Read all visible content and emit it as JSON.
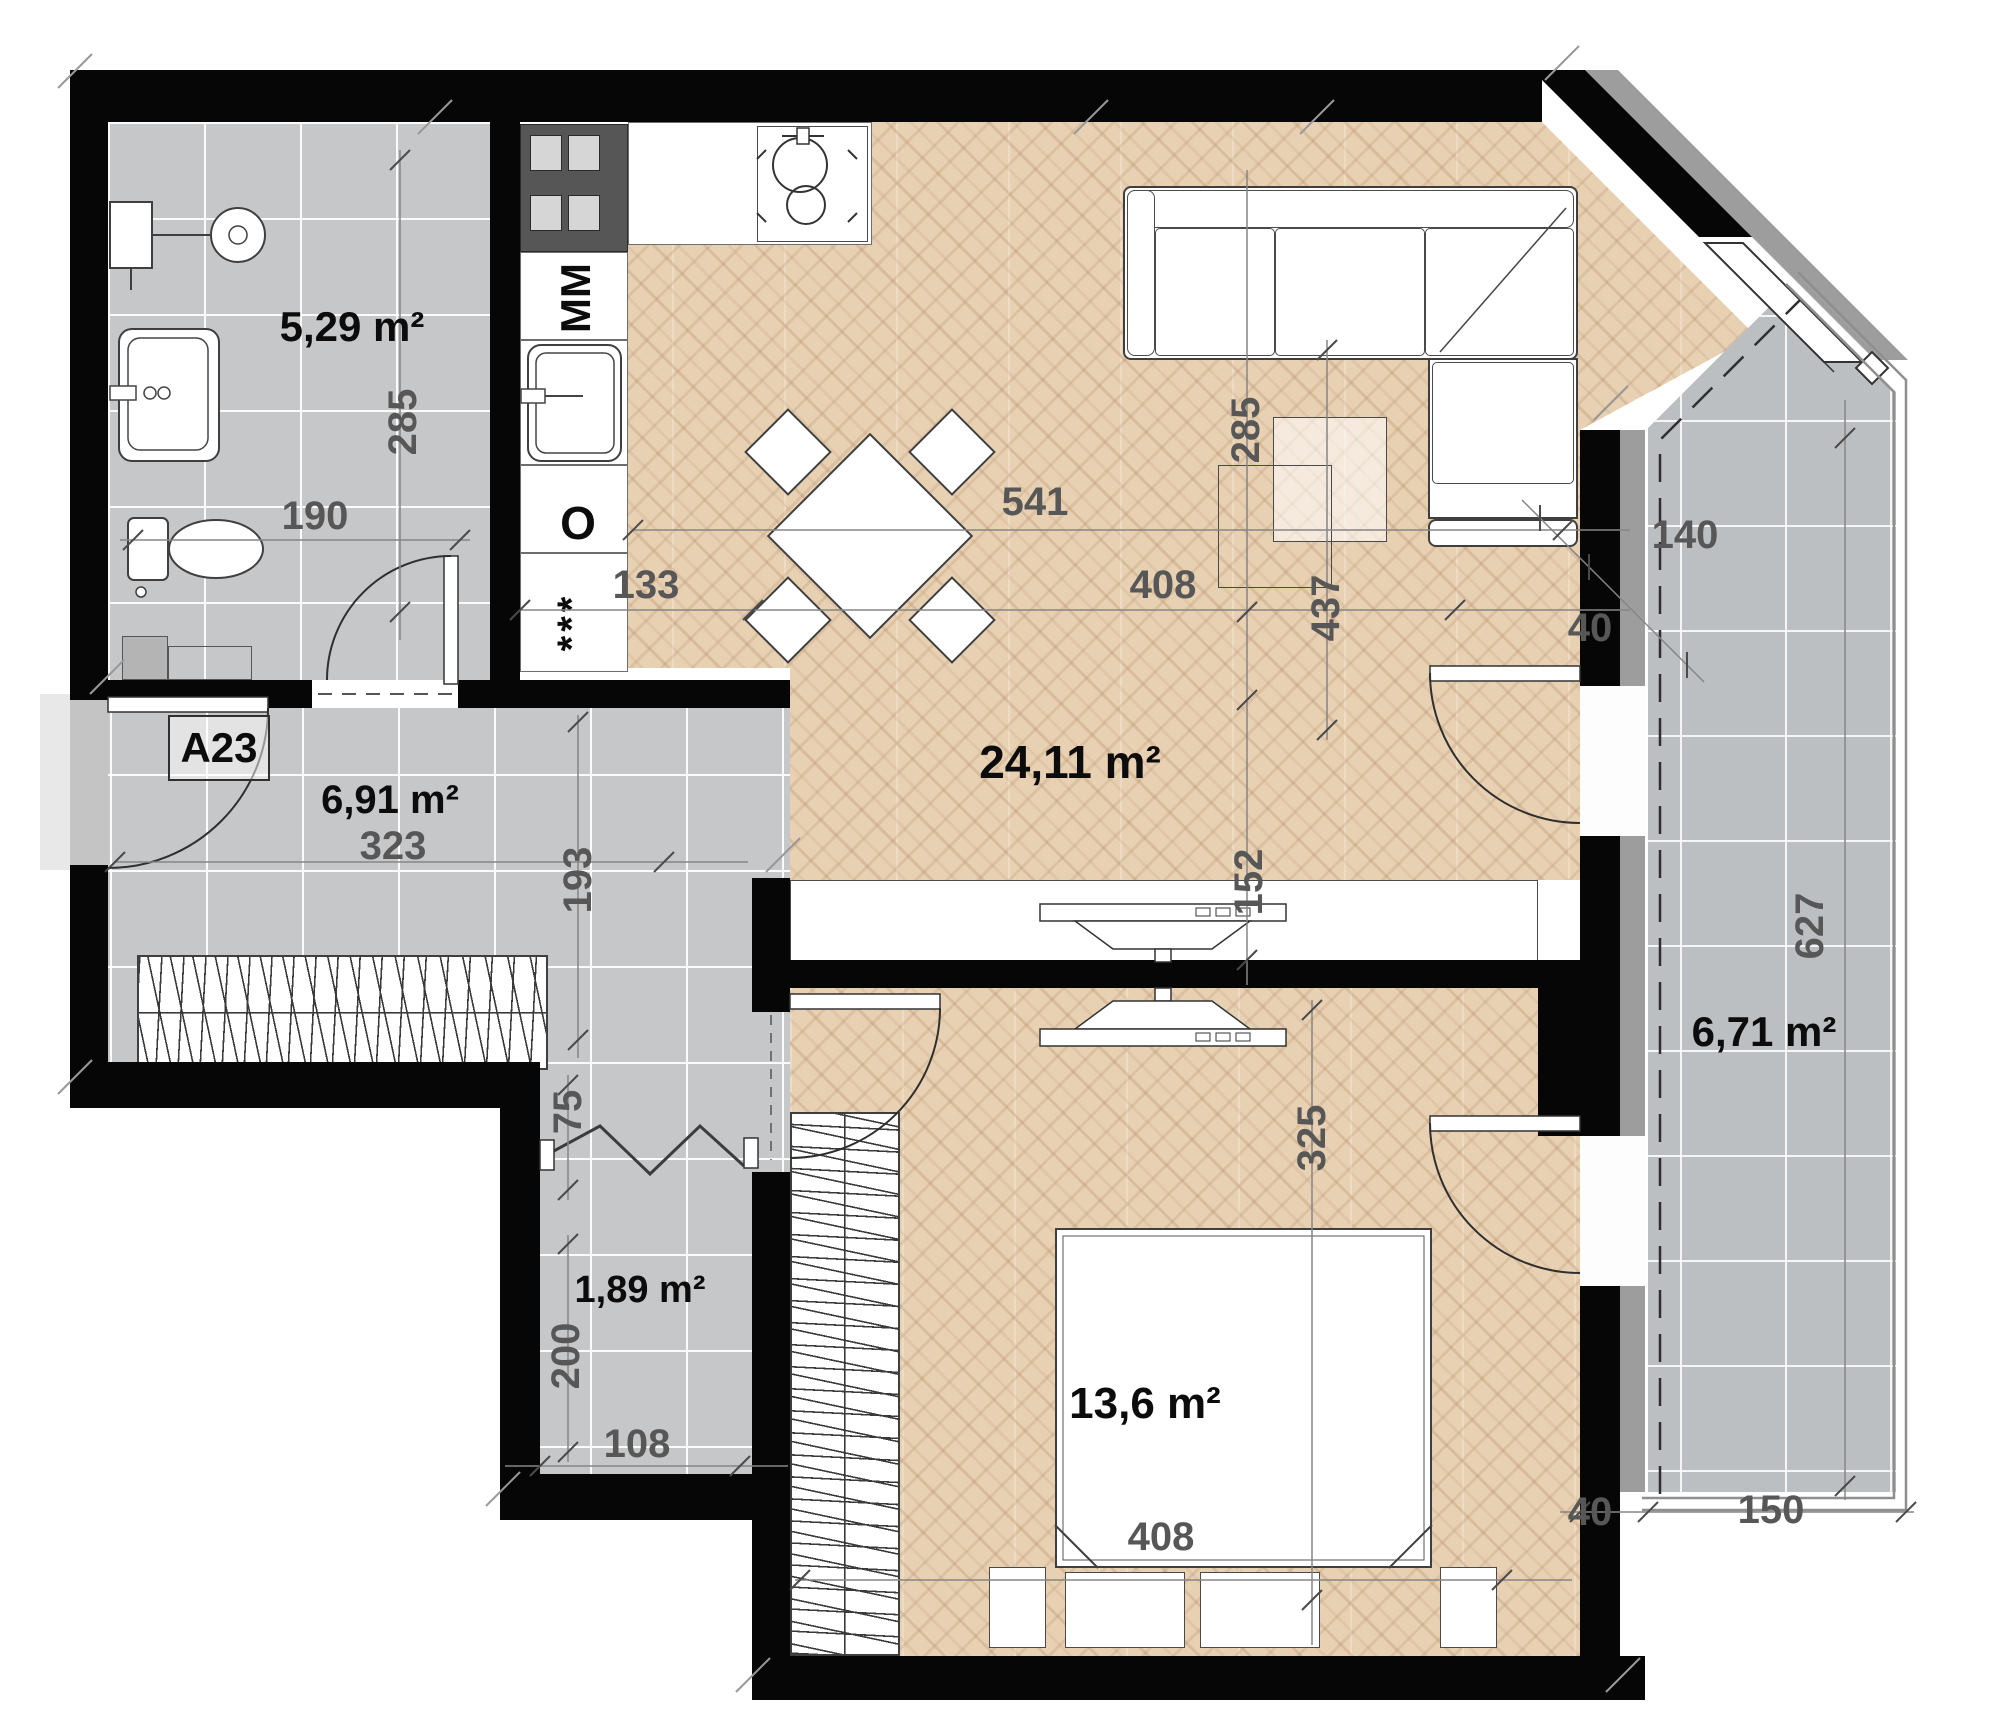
{
  "unit": {
    "id": "A23"
  },
  "rooms": [
    {
      "key": "bathroom",
      "area": "5,29 m²"
    },
    {
      "key": "hall",
      "area": "6,91 m²"
    },
    {
      "key": "storage",
      "area": "1,89 m²"
    },
    {
      "key": "living_kitchen",
      "area": "24,11 m²"
    },
    {
      "key": "bedroom",
      "area": "13,6 m²"
    },
    {
      "key": "balcony",
      "area": "6,71 m²"
    }
  ],
  "kitchen_labels": {
    "dishwasher": "MM",
    "oven": "O",
    "fridge": "***"
  },
  "dimensions": [
    {
      "text": "285"
    },
    {
      "text": "190"
    },
    {
      "text": "133"
    },
    {
      "text": "541"
    },
    {
      "text": "408"
    },
    {
      "text": "285"
    },
    {
      "text": "437"
    },
    {
      "text": "140"
    },
    {
      "text": "40"
    },
    {
      "text": "152"
    },
    {
      "text": "323"
    },
    {
      "text": "193"
    },
    {
      "text": "75"
    },
    {
      "text": "200"
    },
    {
      "text": "108"
    },
    {
      "text": "325"
    },
    {
      "text": "408"
    },
    {
      "text": "40"
    },
    {
      "text": "150"
    },
    {
      "text": "627"
    }
  ],
  "colors": {
    "wall": "#060606",
    "parquet": "#e8d1b3",
    "tile": "#c6c7c9",
    "balcony_tile": "#bcbfc2",
    "sill": "#9d9d9d",
    "dim_text": "#575757"
  }
}
